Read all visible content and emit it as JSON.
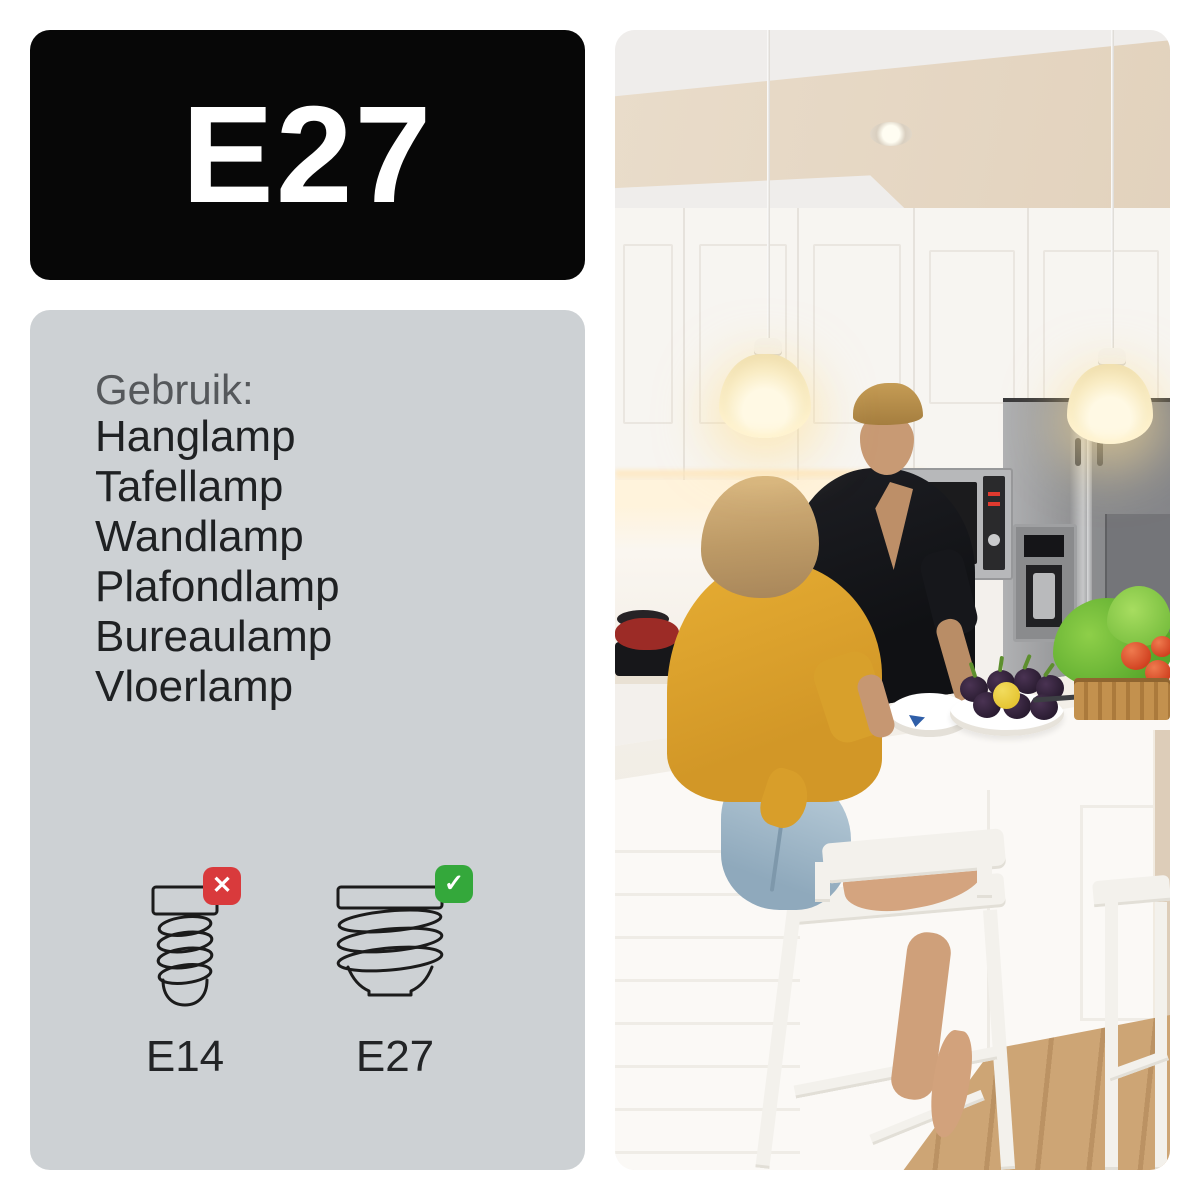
{
  "header": {
    "fitting_label": "E27"
  },
  "usage_panel": {
    "heading": "Gebruik:",
    "items": [
      "Hanglamp",
      "Tafellamp",
      "Wandlamp",
      "Plafondlamp",
      "Bureaulamp",
      "Vloerlamp"
    ],
    "comparison": {
      "incompatible": {
        "label": "E14",
        "badge_glyph": "✕",
        "badge_icon": "cross-icon"
      },
      "compatible": {
        "label": "E27",
        "badge_glyph": "✓",
        "badge_icon": "check-icon"
      }
    }
  },
  "colors": {
    "header_bg": "#070707",
    "header_text": "#ffffff",
    "panel_bg": "#cdd1d4",
    "text_primary": "#1f2123",
    "text_secondary": "#55585b",
    "badge_red": "#d93a3c",
    "badge_green": "#34a83b",
    "shirt_yellow": "#dda32f"
  }
}
